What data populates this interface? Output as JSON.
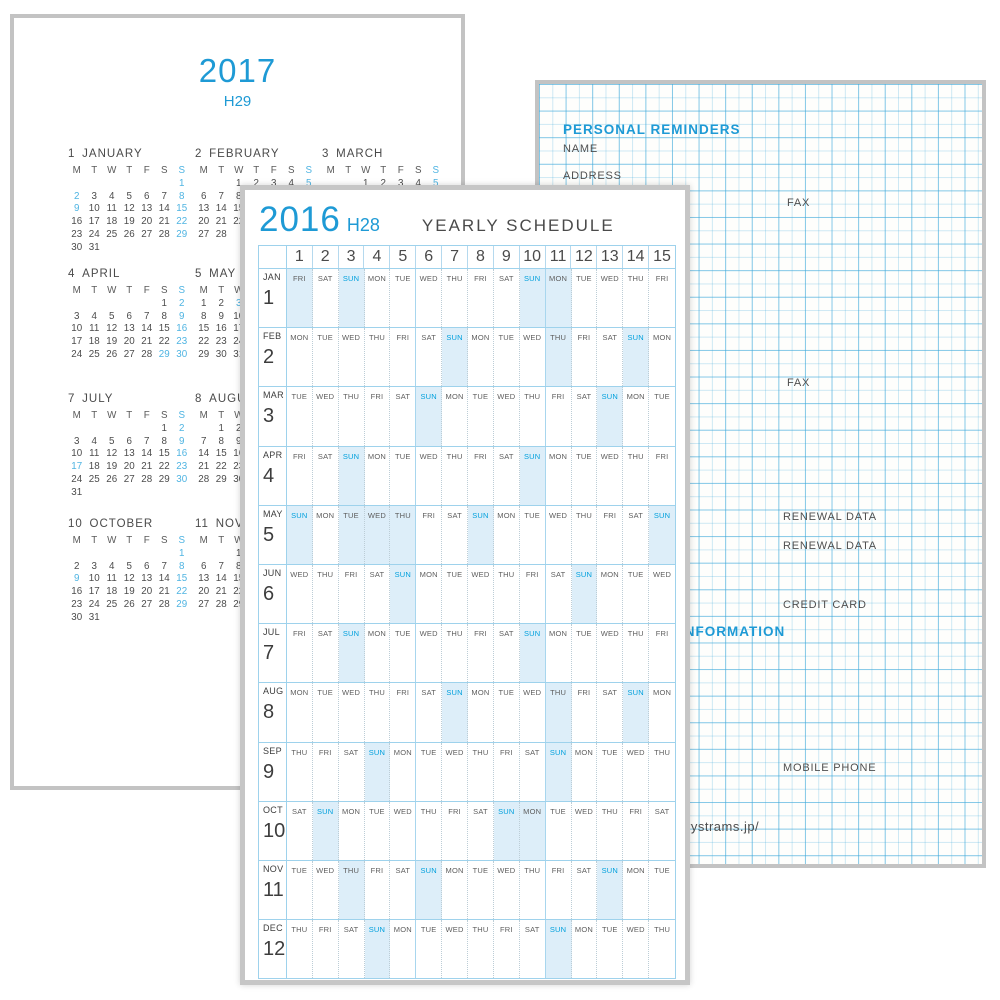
{
  "palette": {
    "accent_blue": "#1e9ad5",
    "minical_blue": "#4fb4e2",
    "sun_blue": "#00a0dd",
    "band_blue": "#ddeef9",
    "table_line_blue": "#9ed2ec",
    "grid_line_blue": "#3ca8da",
    "page_border_gray": "#c3c3c3",
    "text_gray": "#4a4a4a"
  },
  "page2017": {
    "year": "2017",
    "era": "H29",
    "day_headers": [
      "M",
      "T",
      "W",
      "T",
      "F",
      "S",
      "S"
    ],
    "months": [
      {
        "num": "1",
        "name": "JANUARY",
        "col": 0,
        "row": 0,
        "weeks": [
          [
            "",
            "",
            "",
            "",
            "",
            "",
            "1"
          ],
          [
            "2",
            "3",
            "4",
            "5",
            "6",
            "7",
            "8"
          ],
          [
            "9",
            "10",
            "11",
            "12",
            "13",
            "14",
            "15"
          ],
          [
            "16",
            "17",
            "18",
            "19",
            "20",
            "21",
            "22"
          ],
          [
            "23",
            "24",
            "25",
            "26",
            "27",
            "28",
            "29"
          ],
          [
            "30",
            "31",
            "",
            "",
            "",
            "",
            ""
          ]
        ],
        "blue": [
          "1",
          "2",
          "8",
          "9",
          "15",
          "22",
          "29"
        ]
      },
      {
        "num": "2",
        "name": "FEBRUARY",
        "col": 1,
        "row": 0,
        "weeks": [
          [
            "",
            "",
            "1",
            "2",
            "3",
            "4",
            "5"
          ],
          [
            "6",
            "7",
            "8",
            "9",
            "10",
            "11",
            "12"
          ],
          [
            "13",
            "14",
            "15",
            "16",
            "17",
            "18",
            "19"
          ],
          [
            "20",
            "21",
            "22",
            "23",
            "24",
            "25",
            "26"
          ],
          [
            "27",
            "28",
            "",
            "",
            "",
            "",
            ""
          ]
        ],
        "blue": [
          "5",
          "11",
          "12",
          "19",
          "26"
        ]
      },
      {
        "num": "3",
        "name": "MARCH",
        "col": 2,
        "row": 0,
        "weeks": [
          [
            "",
            "",
            "1",
            "2",
            "3",
            "4",
            "5"
          ],
          [
            "6",
            "7",
            "8",
            "9",
            "10",
            "11",
            "12"
          ],
          [
            "13",
            "14",
            "15",
            "16",
            "17",
            "18",
            "19"
          ],
          [
            "20",
            "21",
            "22",
            "23",
            "24",
            "25",
            "26"
          ],
          [
            "27",
            "28",
            "29",
            "30",
            "31",
            "",
            ""
          ]
        ],
        "blue": [
          "5",
          "12",
          "19",
          "20",
          "26"
        ]
      },
      {
        "num": "4",
        "name": "APRIL",
        "col": 0,
        "row": 1,
        "weeks": [
          [
            "",
            "",
            "",
            "",
            "",
            "1",
            "2"
          ],
          [
            "3",
            "4",
            "5",
            "6",
            "7",
            "8",
            "9"
          ],
          [
            "10",
            "11",
            "12",
            "13",
            "14",
            "15",
            "16"
          ],
          [
            "17",
            "18",
            "19",
            "20",
            "21",
            "22",
            "23"
          ],
          [
            "24",
            "25",
            "26",
            "27",
            "28",
            "29",
            "30"
          ]
        ],
        "blue": [
          "2",
          "9",
          "16",
          "23",
          "29",
          "30"
        ]
      },
      {
        "num": "5",
        "name": "MAY",
        "col": 1,
        "row": 1,
        "weeks": [
          [
            "1",
            "2",
            "3",
            "4",
            "5",
            "6",
            "7"
          ],
          [
            "8",
            "9",
            "10",
            "11",
            "12",
            "13",
            "14"
          ],
          [
            "15",
            "16",
            "17",
            "18",
            "19",
            "20",
            "21"
          ],
          [
            "22",
            "23",
            "24",
            "25",
            "26",
            "27",
            "28"
          ],
          [
            "29",
            "30",
            "31",
            "",
            "",
            "",
            ""
          ]
        ],
        "blue": [
          "3",
          "4",
          "5",
          "7",
          "14",
          "21",
          "28"
        ]
      },
      {
        "num": "7",
        "name": "JULY",
        "col": 0,
        "row": 2,
        "weeks": [
          [
            "",
            "",
            "",
            "",
            "",
            "1",
            "2"
          ],
          [
            "3",
            "4",
            "5",
            "6",
            "7",
            "8",
            "9"
          ],
          [
            "10",
            "11",
            "12",
            "13",
            "14",
            "15",
            "16"
          ],
          [
            "17",
            "18",
            "19",
            "20",
            "21",
            "22",
            "23"
          ],
          [
            "24",
            "25",
            "26",
            "27",
            "28",
            "29",
            "30"
          ],
          [
            "31",
            "",
            "",
            "",
            "",
            "",
            ""
          ]
        ],
        "blue": [
          "2",
          "9",
          "16",
          "17",
          "23",
          "30"
        ]
      },
      {
        "num": "8",
        "name": "AUGUST",
        "col": 1,
        "row": 2,
        "weeks": [
          [
            "",
            "1",
            "2",
            "3",
            "4",
            "5",
            "6"
          ],
          [
            "7",
            "8",
            "9",
            "10",
            "11",
            "12",
            "13"
          ],
          [
            "14",
            "15",
            "16",
            "17",
            "18",
            "19",
            "20"
          ],
          [
            "21",
            "22",
            "23",
            "24",
            "25",
            "26",
            "27"
          ],
          [
            "28",
            "29",
            "30",
            "31",
            "",
            "",
            ""
          ]
        ],
        "blue": [
          "6",
          "11",
          "13",
          "20",
          "27"
        ]
      },
      {
        "num": "10",
        "name": "OCTOBER",
        "col": 0,
        "row": 3,
        "weeks": [
          [
            "",
            "",
            "",
            "",
            "",
            "",
            "1"
          ],
          [
            "2",
            "3",
            "4",
            "5",
            "6",
            "7",
            "8"
          ],
          [
            "9",
            "10",
            "11",
            "12",
            "13",
            "14",
            "15"
          ],
          [
            "16",
            "17",
            "18",
            "19",
            "20",
            "21",
            "22"
          ],
          [
            "23",
            "24",
            "25",
            "26",
            "27",
            "28",
            "29"
          ],
          [
            "30",
            "31",
            "",
            "",
            "",
            "",
            ""
          ]
        ],
        "blue": [
          "1",
          "8",
          "9",
          "15",
          "22",
          "29"
        ]
      },
      {
        "num": "11",
        "name": "NOVEMBER",
        "col": 1,
        "row": 3,
        "weeks": [
          [
            "",
            "",
            "1",
            "2",
            "3",
            "4",
            "5"
          ],
          [
            "6",
            "7",
            "8",
            "9",
            "10",
            "11",
            "12"
          ],
          [
            "13",
            "14",
            "15",
            "16",
            "17",
            "18",
            "19"
          ],
          [
            "20",
            "21",
            "22",
            "23",
            "24",
            "25",
            "26"
          ],
          [
            "27",
            "28",
            "29",
            "30",
            "",
            "",
            ""
          ]
        ],
        "blue": [
          "3",
          "5",
          "12",
          "19",
          "23",
          "26"
        ]
      }
    ]
  },
  "page2016": {
    "year": "2016",
    "era": "H28",
    "title": "YEARLY SCHEDULE",
    "day_numbers": [
      "1",
      "2",
      "3",
      "4",
      "5",
      "6",
      "7",
      "8",
      "9",
      "10",
      "11",
      "12",
      "13",
      "14",
      "15"
    ],
    "rows": [
      {
        "abbr": "JAN",
        "num": "1",
        "days": [
          "FRI",
          "SAT",
          "SUN",
          "MON",
          "TUE",
          "WED",
          "THU",
          "FRI",
          "SAT",
          "SUN",
          "MON",
          "TUE",
          "WED",
          "THU",
          "FRI"
        ],
        "highlight": [
          1,
          3,
          10,
          11
        ]
      },
      {
        "abbr": "FEB",
        "num": "2",
        "days": [
          "MON",
          "TUE",
          "WED",
          "THU",
          "FRI",
          "SAT",
          "SUN",
          "MON",
          "TUE",
          "WED",
          "THU",
          "FRI",
          "SAT",
          "SUN",
          "MON"
        ],
        "highlight": [
          7,
          11,
          14
        ]
      },
      {
        "abbr": "MAR",
        "num": "3",
        "days": [
          "TUE",
          "WED",
          "THU",
          "FRI",
          "SAT",
          "SUN",
          "MON",
          "TUE",
          "WED",
          "THU",
          "FRI",
          "SAT",
          "SUN",
          "MON",
          "TUE"
        ],
        "highlight": [
          6,
          13
        ]
      },
      {
        "abbr": "APR",
        "num": "4",
        "days": [
          "FRI",
          "SAT",
          "SUN",
          "MON",
          "TUE",
          "WED",
          "THU",
          "FRI",
          "SAT",
          "SUN",
          "MON",
          "TUE",
          "WED",
          "THU",
          "FRI"
        ],
        "highlight": [
          3,
          10
        ]
      },
      {
        "abbr": "MAY",
        "num": "5",
        "days": [
          "SUN",
          "MON",
          "TUE",
          "WED",
          "THU",
          "FRI",
          "SAT",
          "SUN",
          "MON",
          "TUE",
          "WED",
          "THU",
          "FRI",
          "SAT",
          "SUN"
        ],
        "highlight": [
          1,
          3,
          4,
          5,
          8,
          15
        ]
      },
      {
        "abbr": "JUN",
        "num": "6",
        "days": [
          "WED",
          "THU",
          "FRI",
          "SAT",
          "SUN",
          "MON",
          "TUE",
          "WED",
          "THU",
          "FRI",
          "SAT",
          "SUN",
          "MON",
          "TUE",
          "WED"
        ],
        "highlight": [
          5,
          12
        ]
      },
      {
        "abbr": "JUL",
        "num": "7",
        "days": [
          "FRI",
          "SAT",
          "SUN",
          "MON",
          "TUE",
          "WED",
          "THU",
          "FRI",
          "SAT",
          "SUN",
          "MON",
          "TUE",
          "WED",
          "THU",
          "FRI"
        ],
        "highlight": [
          3,
          10
        ]
      },
      {
        "abbr": "AUG",
        "num": "8",
        "days": [
          "MON",
          "TUE",
          "WED",
          "THU",
          "FRI",
          "SAT",
          "SUN",
          "MON",
          "TUE",
          "WED",
          "THU",
          "FRI",
          "SAT",
          "SUN",
          "MON"
        ],
        "highlight": [
          7,
          11,
          14
        ]
      },
      {
        "abbr": "SEP",
        "num": "9",
        "days": [
          "THU",
          "FRI",
          "SAT",
          "SUN",
          "MON",
          "TUE",
          "WED",
          "THU",
          "FRI",
          "SAT",
          "SUN",
          "MON",
          "TUE",
          "WED",
          "THU"
        ],
        "highlight": [
          4,
          11
        ]
      },
      {
        "abbr": "OCT",
        "num": "10",
        "days": [
          "SAT",
          "SUN",
          "MON",
          "TUE",
          "WED",
          "THU",
          "FRI",
          "SAT",
          "SUN",
          "MON",
          "TUE",
          "WED",
          "THU",
          "FRI",
          "SAT"
        ],
        "highlight": [
          2,
          9,
          10
        ]
      },
      {
        "abbr": "NOV",
        "num": "11",
        "days": [
          "TUE",
          "WED",
          "THU",
          "FRI",
          "SAT",
          "SUN",
          "MON",
          "TUE",
          "WED",
          "THU",
          "FRI",
          "SAT",
          "SUN",
          "MON",
          "TUE"
        ],
        "highlight": [
          3,
          6,
          13
        ]
      },
      {
        "abbr": "DEC",
        "num": "12",
        "days": [
          "THU",
          "FRI",
          "SAT",
          "SUN",
          "MON",
          "TUE",
          "WED",
          "THU",
          "FRI",
          "SAT",
          "SUN",
          "MON",
          "TUE",
          "WED",
          "THU"
        ],
        "highlight": [
          4,
          11
        ]
      }
    ]
  },
  "gridPage": {
    "labels": [
      {
        "text": "PERSONAL REMINDERS",
        "x": 24,
        "y": 38,
        "style": "blue-head",
        "name": "personal-reminders-heading"
      },
      {
        "text": "NAME",
        "x": 24,
        "y": 59,
        "style": "gray",
        "name": "name-label"
      },
      {
        "text": "ADDRESS",
        "x": 24,
        "y": 86,
        "style": "gray",
        "name": "address-label"
      },
      {
        "text": "FAX",
        "x": 248,
        "y": 113,
        "style": "gray",
        "name": "fax-label"
      },
      {
        "text": "FAX",
        "x": 248,
        "y": 293,
        "style": "gray",
        "name": "fax-label"
      },
      {
        "text": "RENEWAL DATA",
        "x": 244,
        "y": 427,
        "style": "gray",
        "name": "renewal-data-label"
      },
      {
        "text": "RENEWAL DATA",
        "x": 244,
        "y": 456,
        "style": "gray",
        "name": "renewal-data-label"
      },
      {
        "text": "CREDIT CARD",
        "x": 244,
        "y": 515,
        "style": "gray",
        "name": "credit-card-label"
      },
      {
        "text": "INFORMATION",
        "x": 141,
        "y": 540,
        "style": "blue-head",
        "name": "information-heading"
      },
      {
        "text": "MOBILE PHONE",
        "x": 244,
        "y": 678,
        "style": "gray",
        "name": "mobile-phone-label"
      },
      {
        "text": "rystrams.jp/",
        "x": 147,
        "y": 735,
        "style": "gray-url",
        "name": "website-url"
      }
    ]
  }
}
